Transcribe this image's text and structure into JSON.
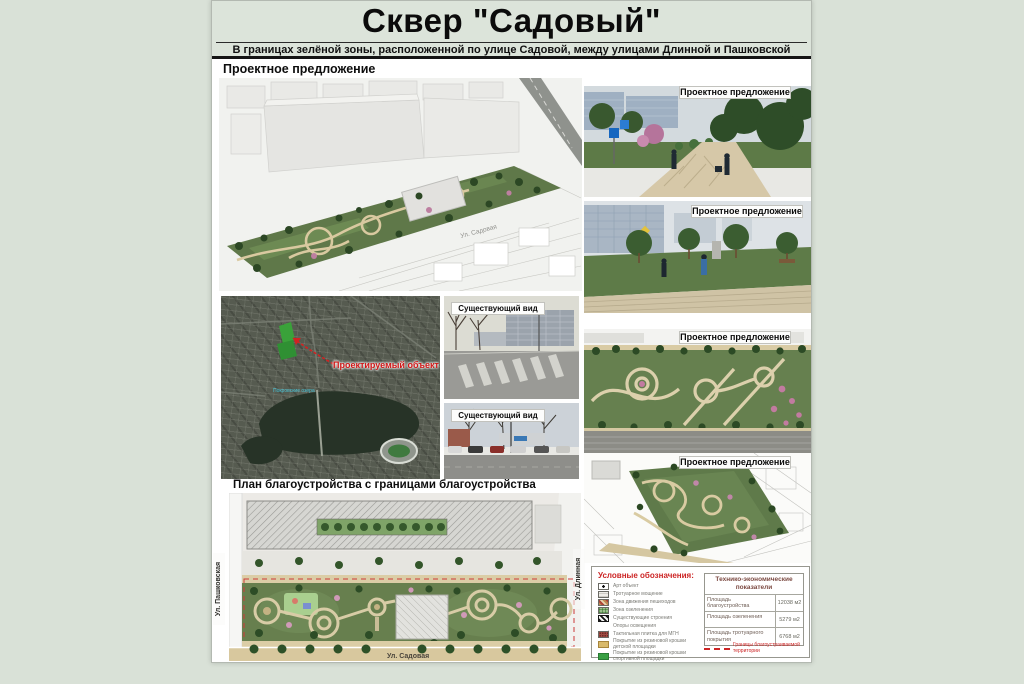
{
  "poster": {
    "title": "Сквер \"Садовый\"",
    "subtitle": "В границах зелёной зоны, расположенной по улице Садовой, между улицами Длинной и Пашковской",
    "section_proposal_heading": "Проектное предложение",
    "section_plan_heading": "План благоустройства с границами благоустройства"
  },
  "labels": {
    "proposal": "Проектное предложение",
    "existing_view": "Существующий вид",
    "project_object": "Проектируемый объект",
    "lake_name": "Покровские озера"
  },
  "streets": {
    "sadovaya": "Ул. Садовая",
    "pashkovskaya": "Ул. Пашковская",
    "dlinnaya": "Ул. Длинная"
  },
  "legend": {
    "title": "Условные обозначения:",
    "items": [
      {
        "icon": "art-object",
        "label": "Арт объект"
      },
      {
        "icon": "paving",
        "label": "Тротуарное мощение"
      },
      {
        "icon": "pedestrian-zone",
        "label": "Зона движения пешеходов"
      },
      {
        "icon": "greening",
        "label": "Зона озеленения"
      },
      {
        "icon": "existing-buildings",
        "label": "Существующие строения"
      },
      {
        "icon": "lighting-line",
        "label": "Опоры освещения"
      },
      {
        "icon": "tactile-paving",
        "label": "Тактильная плитка для МГН"
      },
      {
        "icon": "rubber-kids",
        "label": "Покрытие из резиновой крошки детской площадки"
      },
      {
        "icon": "rubber-sport",
        "label": "Покрытие из резиновой крошки спортивной площадки"
      }
    ],
    "boundary_note": "Границы благоустраиваемой территории"
  },
  "tep_table": {
    "title": "Технико-экономические показатели",
    "rows": [
      {
        "name": "Площадь благоустройства",
        "value": "12038 м2"
      },
      {
        "name": "Площадь озеленения",
        "value": "5279 м2"
      },
      {
        "name": "Площадь тротуарного покрытия",
        "value": "6768 м2"
      }
    ]
  },
  "colors": {
    "page_background": "#d9e1d7",
    "poster_header_band": "#dce4da",
    "accent_red": "#cc2424",
    "park_green": "#677f4e",
    "path_tan": "#d9cba4"
  }
}
